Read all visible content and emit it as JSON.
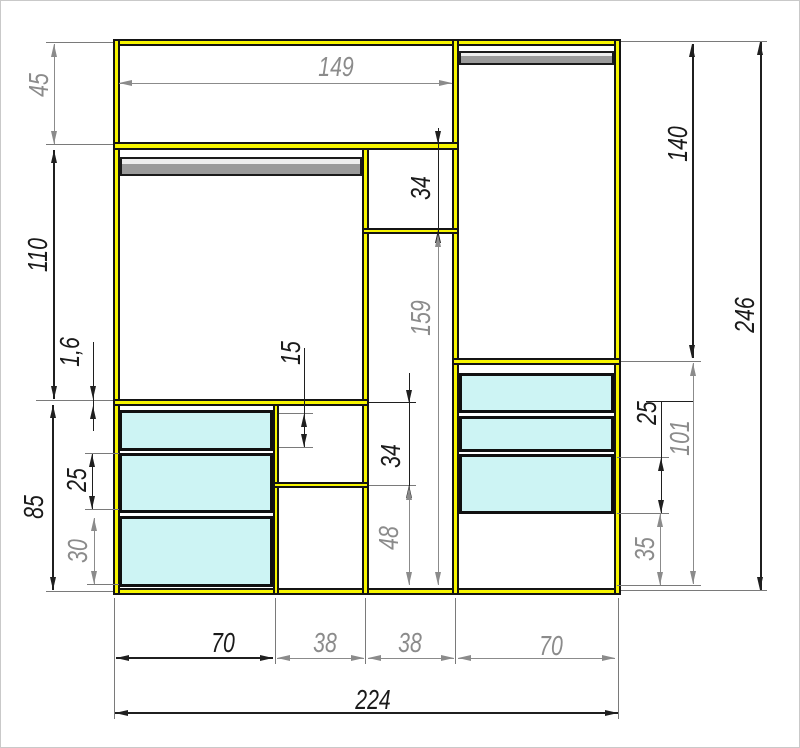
{
  "drawing": {
    "type": "wardrobe-section-technical-drawing",
    "dims": {
      "d45": "45",
      "d110": "110",
      "d1_6": "1,6",
      "d85": "85",
      "d25_left": "25",
      "d30": "30",
      "d15": "15",
      "d149": "149",
      "d34_top": "34",
      "d159": "159",
      "d34_mid": "34",
      "d48": "48",
      "d140": "140",
      "d246": "246",
      "d25_right": "25",
      "d101": "101",
      "d35": "35",
      "d70_left": "70",
      "d38_a": "38",
      "d38_b": "38",
      "d70_right": "70",
      "d224": "224"
    },
    "colors": {
      "panel_yellow": "#f7f500",
      "drawer_cyan": "#cdf4f4",
      "rod_gray": "#9a9a9a",
      "dim_gray": "#8b8b8b",
      "line_black": "#1a1a1a",
      "background": "#ffffff"
    }
  }
}
